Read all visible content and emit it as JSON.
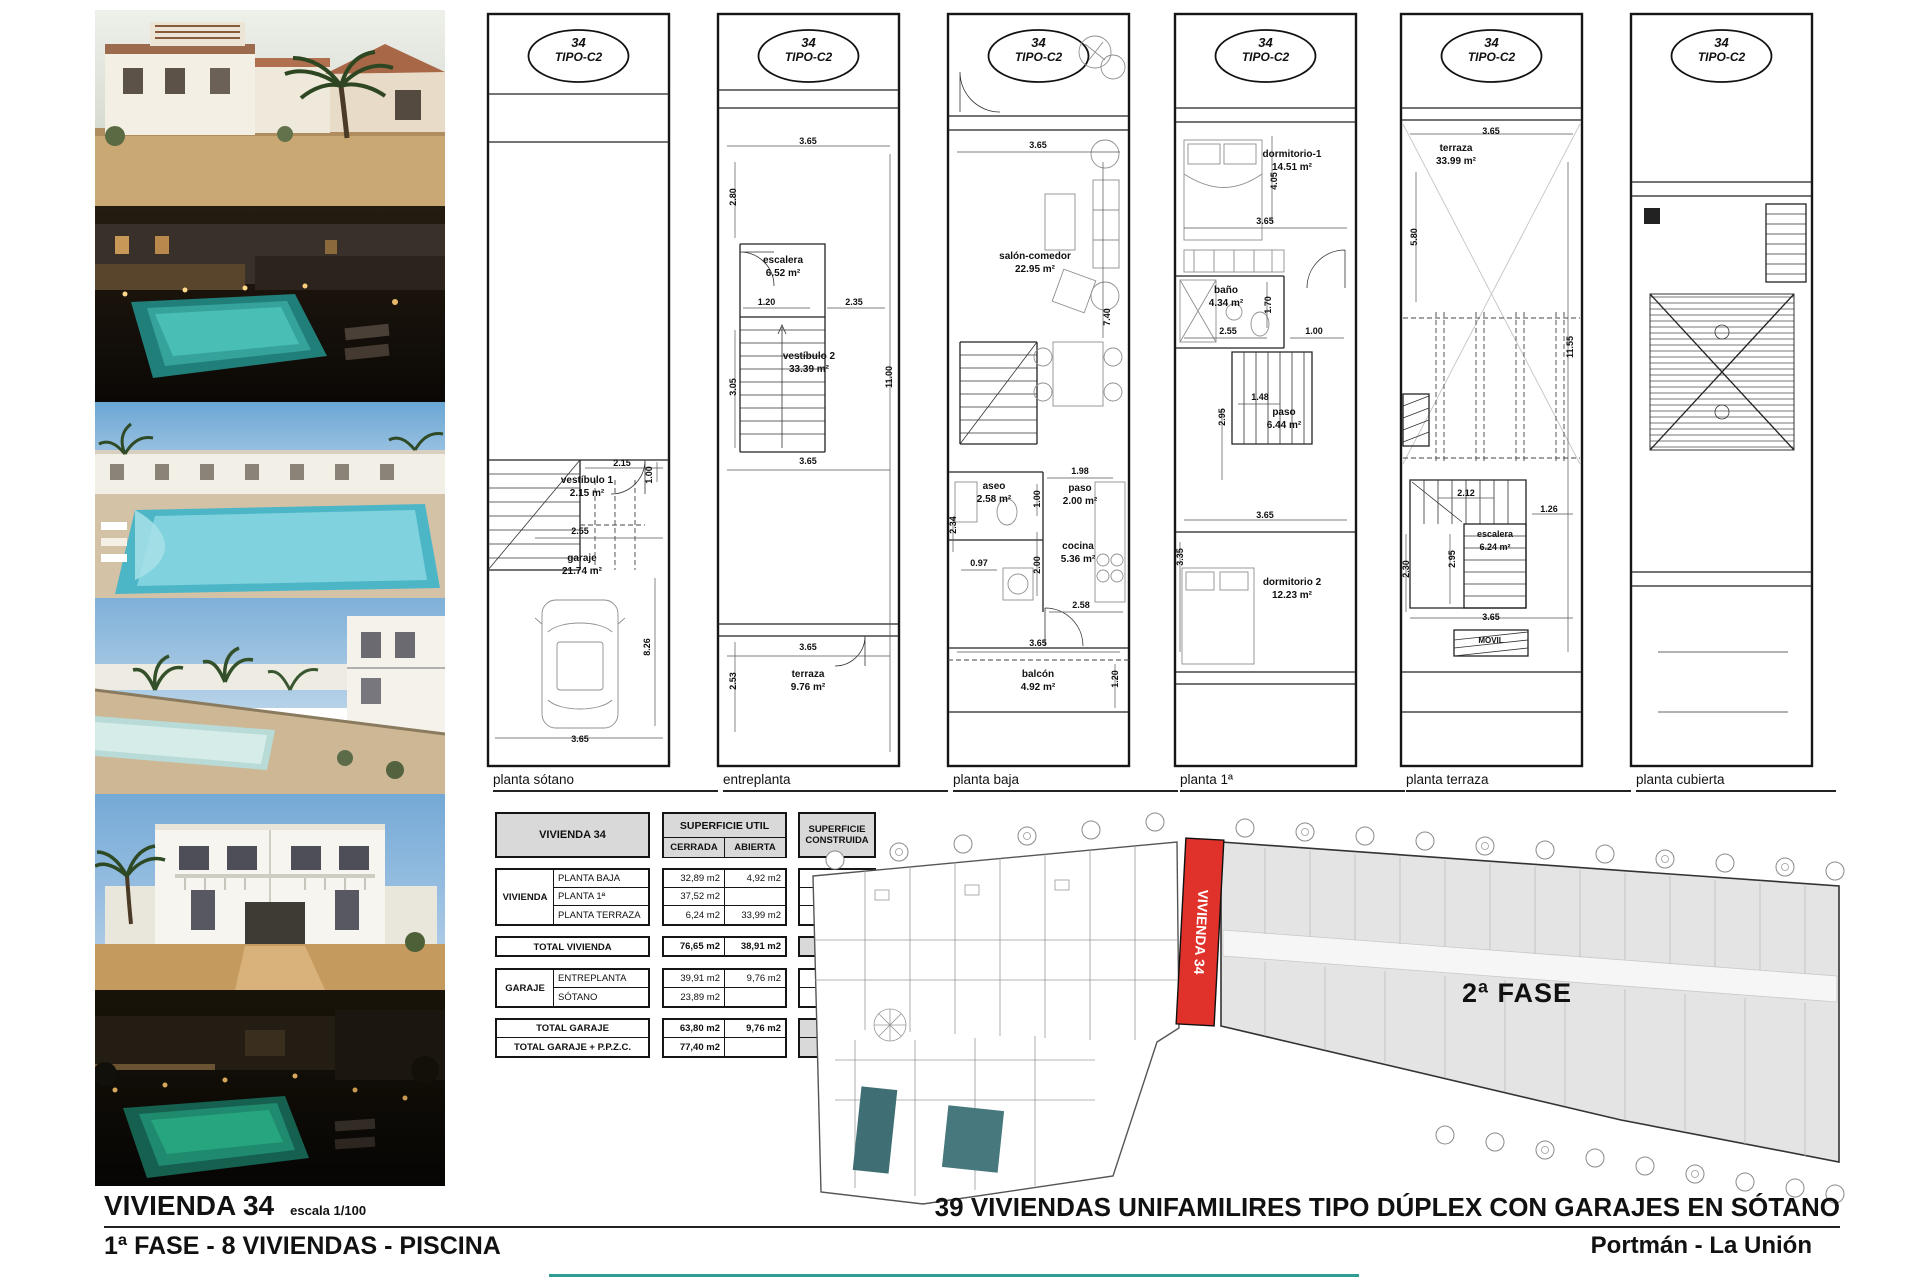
{
  "sheet": {
    "badge": {
      "number": "34",
      "type": "TIPO-C2"
    }
  },
  "plans": [
    {
      "label": "planta sótano",
      "rooms": [
        {
          "name": "vestíbulo 1",
          "area": "2.15 m²"
        },
        {
          "name": "garaje",
          "area": "21.74 m²"
        }
      ],
      "dims": [
        "2.15",
        "1.00",
        "2.55",
        "8.26",
        "3.65"
      ]
    },
    {
      "label": "entreplanta",
      "rooms": [
        {
          "name": "escalera",
          "area": "6.52 m²"
        },
        {
          "name": "vestíbulo 2",
          "area": "33.39 m²"
        },
        {
          "name": "terraza",
          "area": "9.76 m²"
        }
      ],
      "dims": [
        "3.65",
        "2.80",
        "1.20",
        "2.35",
        "11.00",
        "3.05",
        "3.65",
        "2.53",
        "3.65"
      ]
    },
    {
      "label": "planta baja",
      "rooms": [
        {
          "name": "salón-comedor",
          "area": "22.95 m²"
        },
        {
          "name": "aseo",
          "area": "2.58 m²"
        },
        {
          "name": "paso",
          "area": "2.00 m²"
        },
        {
          "name": "cocina",
          "area": "5.36 m²"
        },
        {
          "name": "balcón",
          "area": "4.92 m²"
        }
      ],
      "dims": [
        "3.65",
        "7.40",
        "2.34",
        "0.97",
        "1.98",
        "1.00",
        "2.00",
        "2.58",
        "3.65",
        "1.20"
      ]
    },
    {
      "label": "planta 1ª",
      "rooms": [
        {
          "name": "dormitorio-1",
          "area": "14.51 m²"
        },
        {
          "name": "baño",
          "area": "4.34 m²"
        },
        {
          "name": "paso",
          "area": "6.44 m²"
        },
        {
          "name": "dormitorio 2",
          "area": "12.23 m²"
        }
      ],
      "dims": [
        "4.05",
        "3.65",
        "1.70",
        "2.55",
        "1.00",
        "1.48",
        "2.95",
        "3.65",
        "3.35"
      ]
    },
    {
      "label": "planta terraza",
      "rooms": [
        {
          "name": "terraza",
          "area": "33.99 m²"
        },
        {
          "name": "escalera",
          "area": "6.24 m²"
        }
      ],
      "dims": [
        "3.65",
        "5.80",
        "11.55",
        "2.12",
        "2.95",
        "1.26",
        "2.30",
        "3.65"
      ],
      "note": "MOVIL"
    },
    {
      "label": "planta cubierta",
      "rooms": [],
      "dims": []
    }
  ],
  "table": {
    "title": "VIVIENDA 34",
    "col_util": "SUPERFICIE UTIL",
    "col_cerrada": "CERRADA",
    "col_abierta": "ABIERTA",
    "col_construida": "SUPERFICIE CONSTRUIDA",
    "group1_label": "VIVIENDA",
    "group1_rows": [
      {
        "label": "PLANTA BAJA",
        "cerrada": "32,89 m2",
        "abierta": "4,92 m2",
        "construida": "43,60 m2"
      },
      {
        "label": "PLANTA 1ª",
        "cerrada": "37,52 m2",
        "abierta": "",
        "construida": "48,83 m2"
      },
      {
        "label": "PLANTA TERRAZA",
        "cerrada": "6,24 m2",
        "abierta": "33,99 m2",
        "construida": "8,42 m2"
      }
    ],
    "total1": {
      "label": "TOTAL VIVIENDA",
      "cerrada": "76,65 m2",
      "abierta": "38,91 m2",
      "construida": "100,85 m2"
    },
    "group2_label": "GARAJE",
    "group2_rows": [
      {
        "label": "ENTREPLANTA",
        "cerrada": "39,91 m2",
        "abierta": "9,76 m2",
        "construida": "43,71 m2"
      },
      {
        "label": "SÓTANO",
        "cerrada": "23,89 m2",
        "abierta": "",
        "construida": "29,50 m2"
      }
    ],
    "total2": {
      "label": "TOTAL GARAJE",
      "cerrada": "63,80 m2",
      "abierta": "9,76 m2",
      "construida": "73,21 m2"
    },
    "total3": {
      "label": "TOTAL GARAJE + P.P.Z.C.",
      "cerrada": "77,40 m2",
      "abierta": "",
      "construida": "87,55 m2"
    }
  },
  "siteplan": {
    "phase_label": "2ª FASE",
    "highlight_label": "VIVIENDA 34"
  },
  "footer": {
    "left_title": "VIVIENDA 34",
    "left_scale": "escala 1/100",
    "left_subtitle": "1ª FASE - 8 VIVIENDAS - PISCINA",
    "right_title": "39 VIVIENDAS UNIFAMILIRES TIPO DÚPLEX CON GARAJES EN SÓTANO",
    "right_subtitle": "Portmán - La Unión"
  },
  "colors": {
    "highlight_red": "#e0312a",
    "phase_grey": "#e4e4e4",
    "accent_teal": "#2e9e94"
  }
}
